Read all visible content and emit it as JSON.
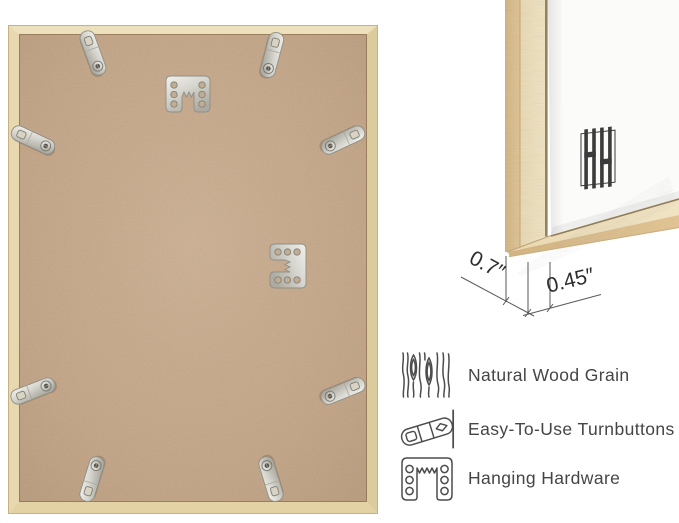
{
  "page": {
    "background": "#ffffff"
  },
  "product_views": {
    "back_view": {
      "description": "back-of-frame-photo",
      "hardware": {
        "turnbuttons": 8,
        "sawtooth_hangers": 2
      },
      "colors": {
        "wood_frame": "#e7d7ae",
        "mdf_backing": "#c1a385",
        "metal_hardware": "#d8d7d1"
      }
    },
    "corner_view": {
      "description": "frame-corner-front-photo",
      "logo_icon": "hh-monogram-logo",
      "colors": {
        "wood_side": "#d9bc8d",
        "wood_face": "#ecdfba",
        "mat": "#fbfbfa"
      },
      "dimensions": {
        "moulding_depth": "0.7″",
        "face_width": "0.45″"
      }
    }
  },
  "features": {
    "items": [
      {
        "icon": "wood-grain-icon",
        "label": "Natural Wood Grain"
      },
      {
        "icon": "turnbutton-icon",
        "label": "Easy-To-Use Turnbuttons"
      },
      {
        "icon": "hanging-hardware-icon",
        "label": "Hanging Hardware"
      }
    ]
  }
}
